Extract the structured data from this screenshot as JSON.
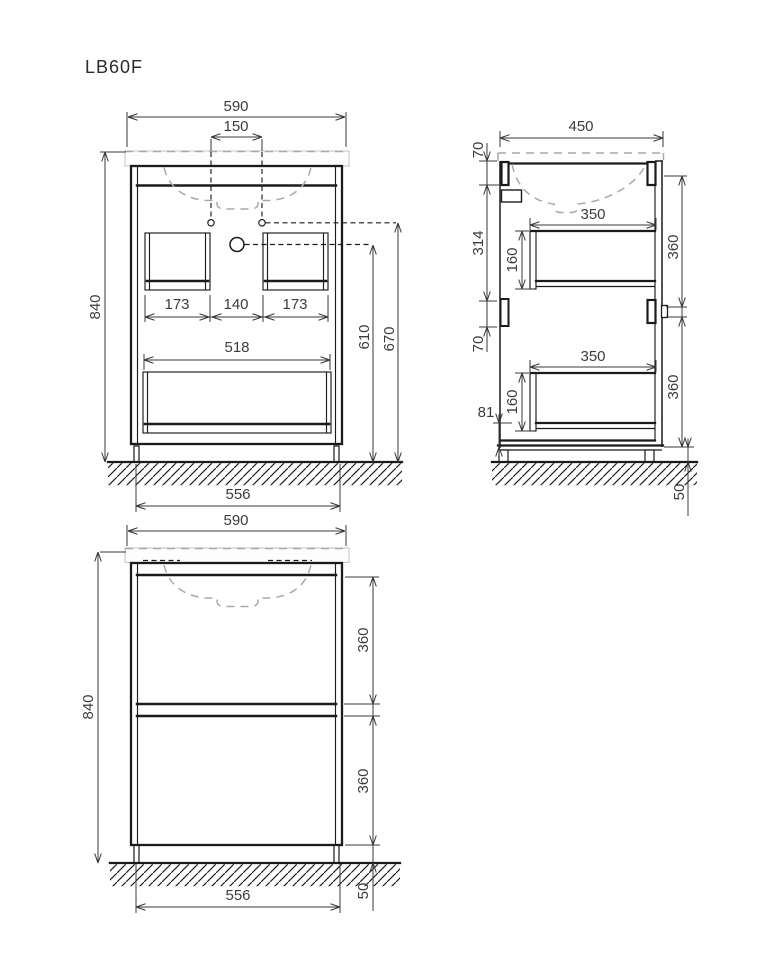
{
  "title": "LB60F",
  "views": {
    "front_open": {
      "width_top": "590",
      "tap_spacing": "150",
      "height": "840",
      "handle_left": "173",
      "handle_center": "140",
      "handle_right": "173",
      "handle_wide": "518",
      "drain_height": "610",
      "overflow_height": "670",
      "base_width": "556"
    },
    "side": {
      "depth": "450",
      "counter_gap": "70",
      "upper_height": "314",
      "hinge_gap": "70",
      "drawer_top_depth": "350",
      "drawer_top_height": "160",
      "front_top_height": "360",
      "bottom_offset": "81",
      "drawer_bottom_depth": "350",
      "drawer_bottom_height": "160",
      "front_bottom_height": "360",
      "leg_height": "50"
    },
    "front_closed": {
      "width_top": "590",
      "height": "840",
      "front_top_height": "360",
      "front_bottom_height": "360",
      "base_width": "556",
      "leg_height": "50"
    }
  }
}
